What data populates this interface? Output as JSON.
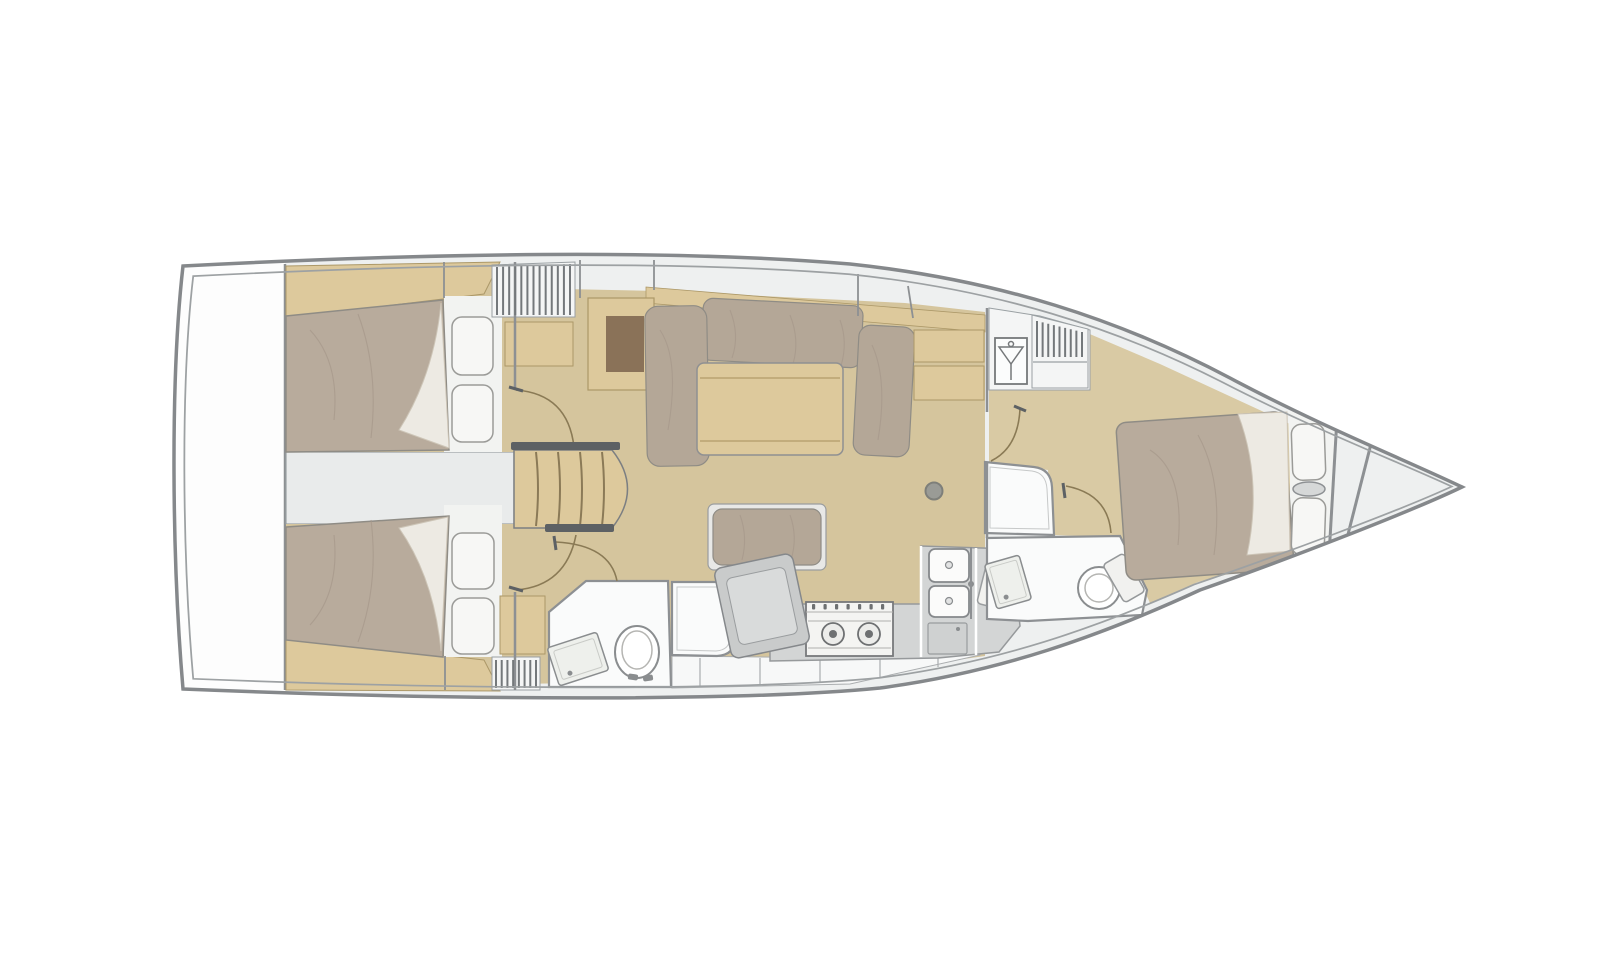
{
  "page": {
    "background_color": "#ffffff",
    "content_type": "sailboat-interior-floor-plan",
    "orientation": "bow-right",
    "visible_text": ""
  },
  "palette": {
    "hull_outline": "#85888b",
    "hull_inner_line": "#9da1a3",
    "deck": "#eef0f0",
    "platform": "#fdfdfd",
    "wall": "#8d9093",
    "wood": "#ddc99c",
    "wood_edge": "#ac9868",
    "wood_line": "#b9a371",
    "stair_tread": "#8b7a57",
    "floor": "#d5c59d",
    "floor_fwd": "#d9caa4",
    "mattress": "#b8ab9c",
    "mattress_edge": "#8f8c85",
    "wrinkle": "#a79a8c",
    "sheet": "#edeae3",
    "sheet_line": "#cdc5b7",
    "pillow": "#f7f7f5",
    "pillow_edge": "#9b9b98",
    "cushion": "#b4a797",
    "fixture": "#fafbfb",
    "fixture_edge": "#8d9093",
    "fixture_inner": "#c6c8c8",
    "counter": "#d3d5d5",
    "counter_edge": "#96999b",
    "appliance": "#c9cbcb",
    "appliance_inner": "#d9dbdb",
    "stove_face": "#f4f4f2",
    "stove_detail": "#6e7072",
    "sink": "#fbfbfa",
    "drain": "#8a8d8f",
    "fridge": "#cfd1d1",
    "louver": "#74787b",
    "louver_bg": "#f4f5f5",
    "threshold": "#5d6164",
    "door_arc": "#8a7a55",
    "tv_inset": "#8a7258",
    "mast_fill": "#9a9b96",
    "mast_edge": "#7e7f7a",
    "locker_band": "#f7f8f8",
    "locker_edge": "#aaadaf",
    "headboard": "#f2f3f1",
    "engine_bay": "#e9ebeb",
    "engine_edge": "#9aa0a3"
  },
  "rooms": [
    {
      "id": "swim-platform",
      "name": "stern swim platform"
    },
    {
      "id": "aft-cabin-port",
      "name": "aft double cabin (top)"
    },
    {
      "id": "aft-cabin-starboard",
      "name": "aft double cabin (bottom)"
    },
    {
      "id": "engine-compartment",
      "name": "engine compartment between aft cabins"
    },
    {
      "id": "companionway-stairs",
      "name": "companionway steps"
    },
    {
      "id": "saloon",
      "name": "saloon with U-settee and table"
    },
    {
      "id": "aft-head",
      "name": "aft head with toilet and sink"
    },
    {
      "id": "aft-shower",
      "name": "aft shower stall"
    },
    {
      "id": "nav-desk",
      "name": "chart table"
    },
    {
      "id": "galley",
      "name": "L-galley with stove, double sink, fridge"
    },
    {
      "id": "forward-shower",
      "name": "forward shower stall"
    },
    {
      "id": "forward-head",
      "name": "forward head with toilet and sink"
    },
    {
      "id": "wardrobe",
      "name": "hanging locker with louvered vents"
    },
    {
      "id": "forward-cabin",
      "name": "forward island-berth cabin"
    },
    {
      "id": "bow-stowage",
      "name": "bow anchor-locker bulkheads"
    }
  ],
  "features": {
    "louver_panels": [
      {
        "id": "a",
        "x1": 497,
        "x2": 570,
        "y1": 267,
        "y2": 315,
        "count": 13,
        "top_slope": -3
      },
      {
        "id": "b",
        "x1": 496,
        "x2": 536,
        "y1": 660,
        "y2": 688,
        "count": 8,
        "top_slope": 0
      },
      {
        "id": "c",
        "x1": 1037,
        "x2": 1082,
        "y1": 321,
        "y2": 357,
        "count": 9,
        "top_slope": 11
      }
    ],
    "stair_treads": {
      "xs": [
        536,
        558,
        580,
        602
      ],
      "y1": 452,
      "y2": 526
    },
    "stove": {
      "burners": 2,
      "knobs": 7
    },
    "galley_sinks": 2,
    "locker_dividers": [
      [
        700,
        658,
        686
      ],
      [
        760,
        658,
        685
      ],
      [
        820,
        658,
        682
      ],
      [
        880,
        657,
        677
      ],
      [
        938,
        656,
        667
      ]
    ],
    "wall_stubs": [
      [
        654,
        260,
        654,
        290
      ],
      [
        858,
        274,
        858,
        316
      ],
      [
        908,
        286,
        913,
        318
      ],
      [
        444,
        262,
        444,
        298
      ],
      [
        445,
        656,
        445,
        690
      ],
      [
        580,
        260,
        580,
        298
      ]
    ]
  }
}
